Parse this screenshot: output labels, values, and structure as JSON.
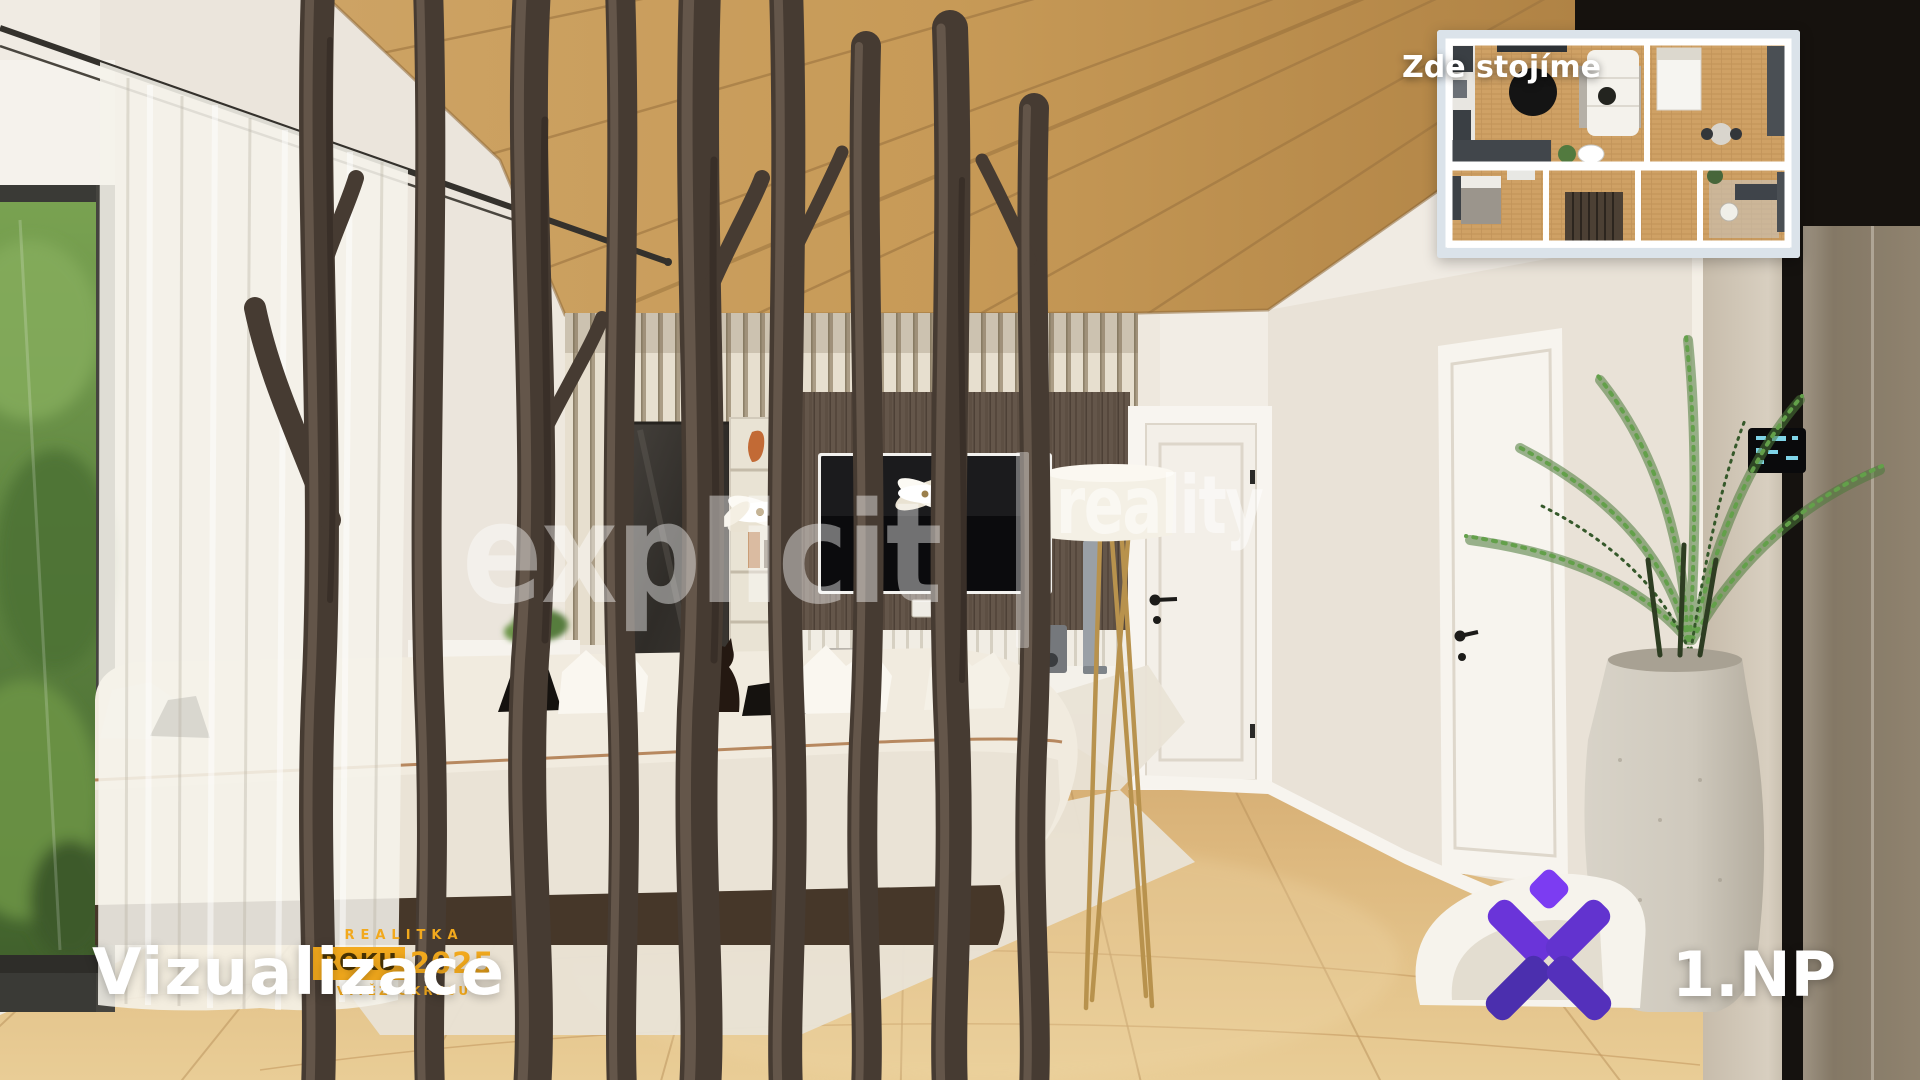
{
  "plan": {
    "label": "Zde stojíme"
  },
  "watermark": {
    "brand": "explicit",
    "divider": "|",
    "suffix": "reality"
  },
  "credit": {
    "title": "Vizualizace",
    "award_line1": "REALITKA",
    "award_word": "ROKU",
    "award_year": "2025",
    "award_line3": "VÍTĚZ OKRESU"
  },
  "floor_tag": {
    "label": "1.NP"
  },
  "icons": {
    "brand_logo": "x-diamond-logo",
    "minimap": "floorplan-minimap"
  },
  "colors": {
    "award_gold": "#F2A91D",
    "award_text_dark": "#4A3404",
    "logo_purple_light": "#7C3CF2",
    "logo_purple_mid": "#6233CF",
    "logo_purple_dark": "#4B2FAE",
    "plan_frame": "#DBE3EA",
    "ceiling_wood": "#C0914F",
    "floor_wood": "#DDBA82",
    "watermark_white": "rgba(255,255,255,0.45)"
  }
}
